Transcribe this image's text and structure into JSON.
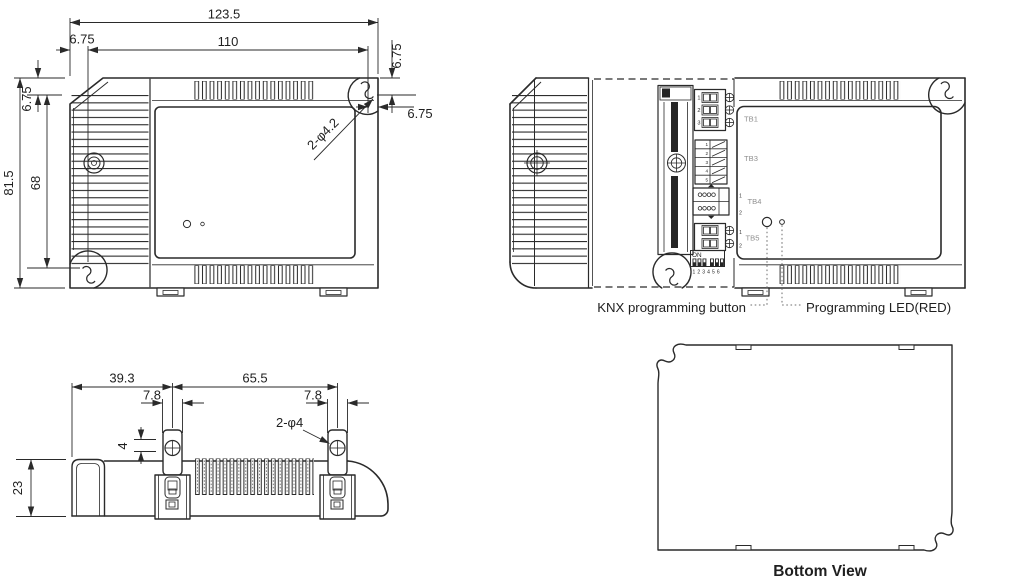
{
  "top_view": {
    "dim_width_overall": "123.5",
    "dim_width_holes": "110",
    "dim_offset_left": "6.75",
    "dim_offset_top": "6.75",
    "dim_offset_right_top": "6.75",
    "dim_offset_right_side": "6.75",
    "dim_height_overall": "81.5",
    "dim_height_holes": "68",
    "hole_callout": "2-φ4.2"
  },
  "internal_view": {
    "terminals": {
      "tb1": "TB1",
      "tb3": "TB3",
      "tb4": "TB4",
      "tb5": "TB5"
    },
    "tb1_pins": [
      "1",
      "2",
      "3"
    ],
    "tb3_pins": [
      "1",
      "2",
      "3",
      "4",
      "5"
    ],
    "tb4_pins": [
      "1",
      "2"
    ],
    "tb5_pins": [
      "1",
      "2"
    ],
    "dip": {
      "label": "ON",
      "numbers": "1 2 3 4 5 6"
    },
    "button_label": "KNX programming button",
    "led_label": "Programming LED(RED)"
  },
  "side_view": {
    "dim_left": "39.3",
    "dim_right": "65.5",
    "dim_slot_left": "7.8",
    "dim_slot_right": "7.8",
    "dim_offset": "4",
    "dim_height": "23",
    "hole_callout": "2-φ4"
  },
  "bottom_view": {
    "caption": "Bottom View"
  },
  "colors": {
    "line": "#2a2a2a",
    "gray_label": "#8f8f8f",
    "leader_dots": "#6e6e6e",
    "background": "#ffffff"
  }
}
